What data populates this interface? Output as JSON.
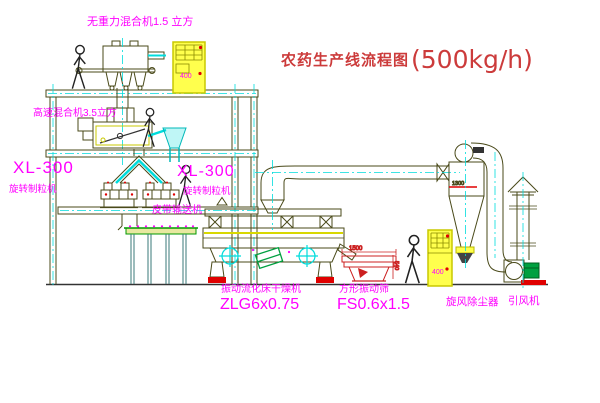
{
  "title": {
    "name": "农药生产线流程图",
    "capacity": "(500kg/h)"
  },
  "labels": {
    "gravity_mixer": "无重力混合机1.5 立方",
    "high_speed_mixer": "高速混合机3.5立方",
    "granulator_left": {
      "model": "XL-300",
      "name": "旋转制粒机"
    },
    "granulator_right": {
      "model": "XL-300",
      "name": "旋转制粒机"
    },
    "belt_conveyor": "皮带输送机",
    "fluid_bed_dryer": {
      "name": "振动流化床干燥机",
      "model": "ZLG6x0.75"
    },
    "vibrating_screen": {
      "name": "方形振动筛",
      "model": "FS0.6x1.5"
    },
    "cyclone": "旋风除尘器",
    "induced_draft_fan": "引风机"
  },
  "annotations": {
    "screen_width_dim": "1500",
    "screen_height_dim": "540",
    "cyclone_dim": "1300",
    "control_cabinet_top_text": "400",
    "control_cabinet_right_text": "400"
  },
  "colors": {
    "label_magenta": "#ff00ff",
    "title_red": "#cc3b3b",
    "line_olive": "#4a4a1a",
    "centerline_cyan": "#00dcdc",
    "cabinet_yellow": "#ffff4d",
    "accent_red": "#e00000",
    "motor_green": "#00a040"
  }
}
